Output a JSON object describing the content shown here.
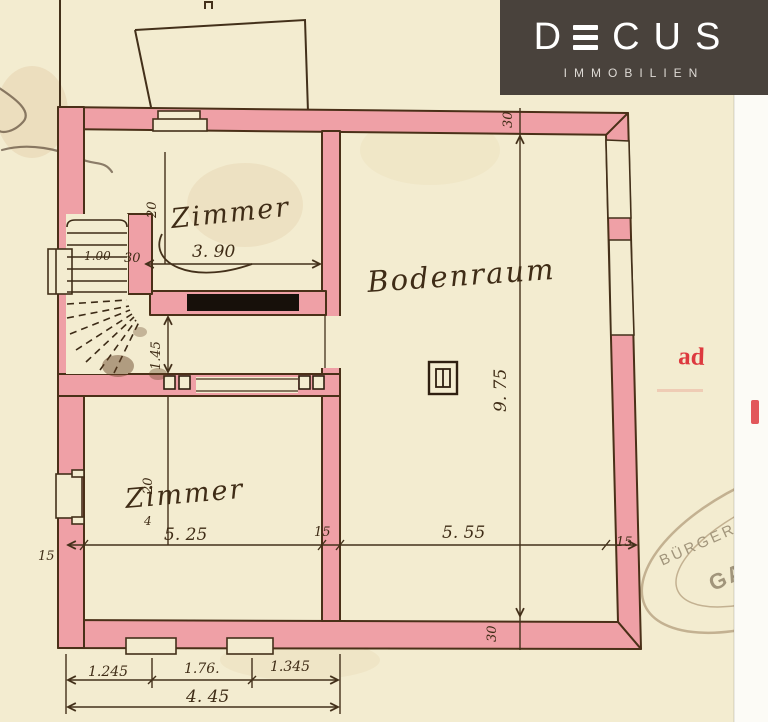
{
  "logo": {
    "letter_d": "D",
    "letters_cus": "CUS",
    "subtitle": "IMMOBILIEN",
    "bg_color": "#49423c",
    "fg_color": "#ffffff"
  },
  "plan": {
    "labels": {
      "zimmer_top": "Zimmer",
      "bodenraum": "Bodenraum",
      "zimmer_bottom": "Zimmer"
    },
    "dims": {
      "zimmer_top_width": "3. 90",
      "zimmer_top_depth": "20",
      "stair_width": "1.00",
      "stair_wall": "30",
      "corridor_depth": "1.45",
      "bodenraum_depth": "9. 75",
      "top_wall": "30",
      "bottom_wall": "30",
      "zimmer_bottom_depth": "20",
      "tick": "4",
      "left_wall": "15",
      "zimmer_bottom_width": "5. 25",
      "mid_wall": "15",
      "bodenraum_width": "5. 55",
      "right_wall": "15",
      "window_left": "1.245",
      "window_mid": "1.76.",
      "window_right": "1.345",
      "total_width": "4. 45"
    },
    "colors": {
      "wall": "#efa0a6",
      "ink": "#43301a",
      "paper": "#f3ecd0",
      "stamp_red": "#dd3a3f"
    }
  },
  "stamps": {
    "red_note": "ad",
    "oval_top": "BÜRGERM",
    "oval_center": "GAM"
  }
}
